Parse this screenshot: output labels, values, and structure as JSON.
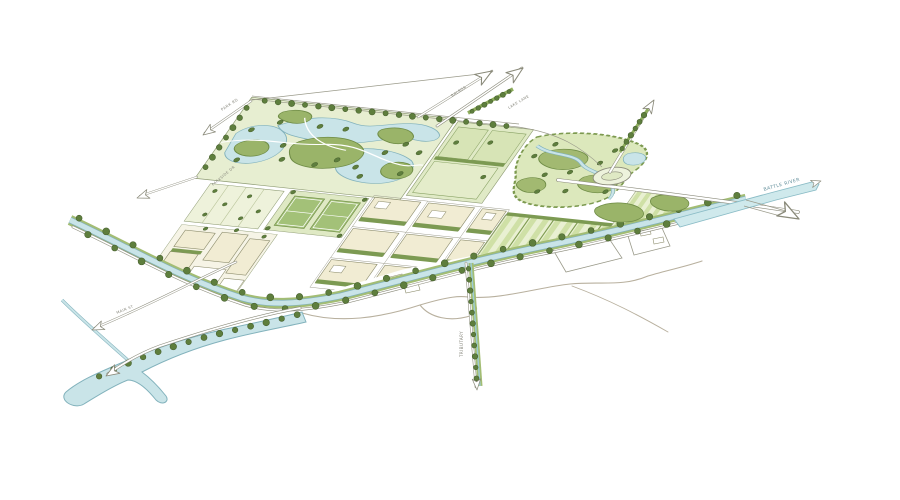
{
  "canvas": {
    "width": 900,
    "height": 500,
    "background": "#ffffff"
  },
  "drawing": {
    "kind": "hand-drawn axonometric master plan illustration",
    "labels": [
      {
        "id": "road-nw",
        "text": "PARK RD",
        "x": 222,
        "y": 111,
        "rot": -33,
        "size": 3.8,
        "color": "#85857a"
      },
      {
        "id": "road-west",
        "text": "PARKSIDE DR",
        "x": 213,
        "y": 186,
        "rot": -40,
        "size": 3.6,
        "color": "#85857a"
      },
      {
        "id": "road-n1",
        "text": "BALBOA",
        "x": 452,
        "y": 97,
        "rot": -33,
        "size": 3.6,
        "color": "#85857a"
      },
      {
        "id": "road-n2",
        "text": "LAKE LANE",
        "x": 509,
        "y": 109,
        "rot": -31,
        "size": 3.6,
        "color": "#85857a"
      },
      {
        "id": "road-sw",
        "text": "MAIN ST",
        "x": 117,
        "y": 314,
        "rot": -22,
        "size": 3.6,
        "color": "#85857a"
      },
      {
        "id": "tributary",
        "text": "TRIBUTARY",
        "x": 463,
        "y": 357,
        "rot": -90,
        "size": 4.0,
        "color": "#85857a"
      },
      {
        "id": "river",
        "text": "BATTLE RIVER",
        "x": 764,
        "y": 191,
        "rot": -16,
        "size": 4.6,
        "color": "#64909c"
      }
    ],
    "palette": {
      "water": "#c9e4e8",
      "water_edge": "#82b2bc",
      "lawn_light": "#e7eed1",
      "lawn_mid": "#dce8c0",
      "mound_green": "#9ab469",
      "mound_edge": "#6f8c46",
      "tree": "#5e7e3d",
      "tree_edge": "#465f2d",
      "hedge": "#7c9a52",
      "block_beige": "#f1ecd3",
      "block_edge": "#8d8d6d",
      "orchard_a": "#cfe0a6",
      "orchard_b": "#e9f0d2",
      "line_gray": "#8a8a7a",
      "dirt_path": "#b8b09e",
      "court_green": "#a3c178"
    },
    "icons": [
      {
        "name": "flow-arrow-icon",
        "glyph": "open outline arrow"
      },
      {
        "name": "tree-icon",
        "glyph": "filled circle"
      }
    ]
  }
}
